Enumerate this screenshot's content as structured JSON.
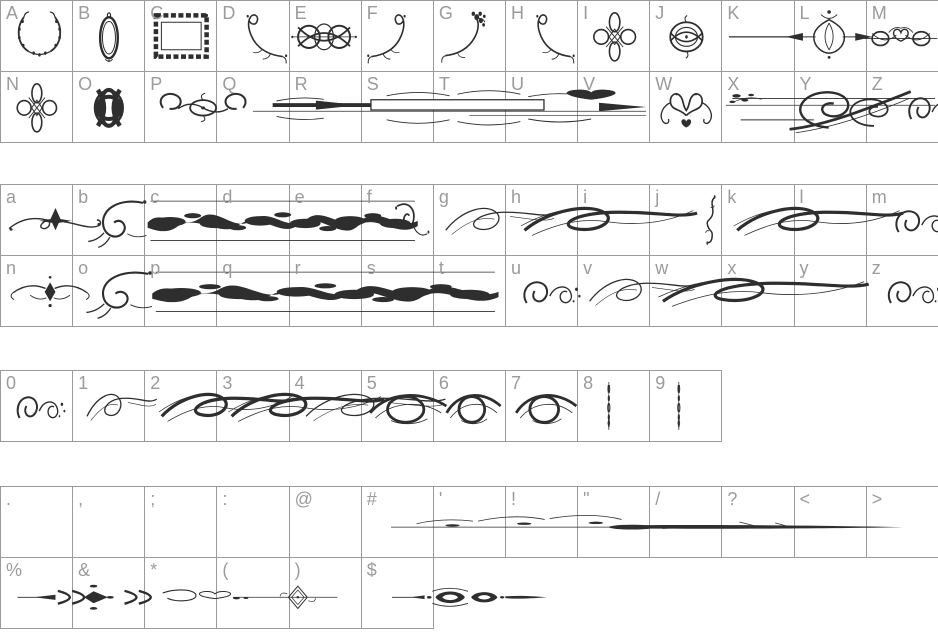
{
  "theme": {
    "background": "#ffffff",
    "grid_color": "#9b9b9b",
    "label_color": "#9b9b9b",
    "glyph_color": "#2e2e2e",
    "banner_fill": "#868686"
  },
  "sections": [
    {
      "name": "uppercase",
      "rows": [
        [
          {
            "label": "A",
            "glyph": "wreath",
            "span": 0.9,
            "dx": 0.08
          },
          {
            "label": "B",
            "glyph": "oval-frame",
            "span": 0.72,
            "dx": 0.14
          },
          {
            "label": "C",
            "glyph": "rect-frame",
            "span": 0.95,
            "dx": 0.03
          },
          {
            "label": "D",
            "glyph": "corner-flourish",
            "span": 0.95,
            "dx": 0.05,
            "flip": true
          },
          {
            "label": "E",
            "glyph": "knot-h",
            "span": 1.0,
            "dx": -0.02
          },
          {
            "label": "F",
            "glyph": "corner-flourish",
            "span": 0.9,
            "dx": 0.05
          },
          {
            "label": "G",
            "glyph": "corner-floral",
            "span": 0.95,
            "dx": 0.05
          },
          {
            "label": "H",
            "glyph": "corner-flourish",
            "span": 0.9,
            "dx": 0.08,
            "flip": true
          },
          {
            "label": "I",
            "glyph": "cross-knot",
            "span": 0.85,
            "dx": 0.08
          },
          {
            "label": "J",
            "glyph": "round-knot",
            "span": 0.9,
            "dx": 0.05
          },
          {
            "label": "K",
            "glyph": "line-divider",
            "span": 1.0,
            "dx": 0.05
          },
          {
            "label": "L",
            "glyph": "spear-knot",
            "span": 1.25,
            "dx": -0.15
          },
          {
            "label": "M",
            "glyph": "heart-scroll",
            "span": 1.05,
            "dx": -0.05
          }
        ],
        [
          {
            "label": "N",
            "glyph": "cross-knot",
            "span": 0.8,
            "dx": 0.1
          },
          {
            "label": "O",
            "glyph": "dense-knot",
            "span": 0.8,
            "dx": 0.1
          },
          {
            "label": "P",
            "glyph": "scroll-divider",
            "span": 1.5,
            "dx": 0.05
          },
          {
            "label": "Q",
            "glyph": "banner-rule",
            "span": 5.45,
            "dx": 0.5
          },
          {
            "label": "R"
          },
          {
            "label": "S"
          },
          {
            "label": "T"
          },
          {
            "label": "U"
          },
          {
            "label": "V"
          },
          {
            "label": "W",
            "glyph": "symmetric-flourish",
            "span": 0.95,
            "dx": 0.03
          },
          {
            "label": "X",
            "glyph": "triple-line",
            "span": 2.9,
            "dx": 0.05
          },
          {
            "label": "Y",
            "glyph": "grand-curl",
            "span": 1.75,
            "dx": -0.1
          },
          {
            "label": "Z",
            "glyph": "curl-cluster",
            "span": 0.9,
            "dx": 0.45
          }
        ]
      ]
    },
    {
      "name": "lowercase",
      "rows": [
        [
          {
            "label": "a",
            "glyph": "fleur-flourish",
            "span": 1.4,
            "dx": 0.05
          },
          {
            "label": "b",
            "glyph": "swirl-leaf",
            "span": 1.15,
            "dx": 0.1
          },
          {
            "label": "c",
            "glyph": "dense-band",
            "span": 3.9,
            "dx": -0.05
          },
          {
            "label": "d"
          },
          {
            "label": "e"
          },
          {
            "label": "f",
            "glyph": "swirl-tail",
            "span": 0.7,
            "dx": 0.3
          },
          {
            "label": "g",
            "glyph": "swash-light",
            "span": 1.65,
            "dx": 0.1
          },
          {
            "label": "h",
            "glyph": "swash-bold",
            "span": 2.6,
            "dx": 0.15
          },
          {
            "label": "i"
          },
          {
            "label": "j",
            "glyph": "small-curl",
            "span": 0.6,
            "dx": 0.55
          },
          {
            "label": "k",
            "glyph": "swash-bold",
            "span": 2.5,
            "dx": 0.1
          },
          {
            "label": "l"
          },
          {
            "label": "m",
            "glyph": "curl-cluster",
            "span": 1.0,
            "dx": 0.25
          }
        ],
        [
          {
            "label": "n",
            "glyph": "small-crest",
            "span": 1.25,
            "dx": 0.05
          },
          {
            "label": "o",
            "glyph": "swirl-leaf",
            "span": 1.3,
            "dx": 0.05
          },
          {
            "label": "p",
            "glyph": "dense-band",
            "span": 5.0,
            "dx": 0.0
          },
          {
            "label": "q"
          },
          {
            "label": "r"
          },
          {
            "label": "s"
          },
          {
            "label": "t"
          },
          {
            "label": "u",
            "glyph": "curl-cluster",
            "span": 1.0,
            "dx": 0.1
          },
          {
            "label": "v",
            "glyph": "swash-light",
            "span": 1.6,
            "dx": 0.1
          },
          {
            "label": "w",
            "glyph": "swash-bold",
            "span": 3.1,
            "dx": 0.05
          },
          {
            "label": "x"
          },
          {
            "label": "y"
          },
          {
            "label": "z",
            "glyph": "curl-cluster",
            "span": 0.95,
            "dx": 0.15
          }
        ]
      ]
    },
    {
      "name": "digits",
      "rows": [
        [
          {
            "label": "0",
            "glyph": "curl-cluster",
            "span": 0.85,
            "dx": 0.1
          },
          {
            "label": "1",
            "glyph": "swash-light",
            "span": 1.05,
            "dx": 0.15
          },
          {
            "label": "2",
            "glyph": "swash-bold",
            "span": 2.0,
            "dx": 0.15
          },
          {
            "label": "3",
            "glyph": "swash-bold",
            "span": 2.3,
            "dx": 0.1
          },
          {
            "label": "4",
            "glyph": "swash-light",
            "span": 2.1,
            "dx": 0.15
          },
          {
            "label": "5",
            "glyph": "round-swash",
            "span": 1.2,
            "dx": 0.05
          },
          {
            "label": "6",
            "glyph": "round-swash",
            "span": 0.85,
            "dx": 0.12
          },
          {
            "label": "7",
            "glyph": "round-swash",
            "span": 0.95,
            "dx": 0.08
          },
          {
            "label": "8",
            "glyph": "mini-stack",
            "span": 0.3,
            "dx": 0.28
          },
          {
            "label": "9",
            "glyph": "mini-stack",
            "span": 0.3,
            "dx": 0.25
          }
        ]
      ]
    },
    {
      "name": "punctuation",
      "rows": [
        [
          {
            "label": "."
          },
          {
            "label": ","
          },
          {
            "label": ";"
          },
          {
            "label": ":"
          },
          {
            "label": "@"
          },
          {
            "label": "#",
            "glyph": "taper-divider",
            "span": 7.1,
            "dx": 0.4
          },
          {
            "label": "'"
          },
          {
            "label": "!"
          },
          {
            "label": "\""
          },
          {
            "label": "/"
          },
          {
            "label": "?"
          },
          {
            "label": "<"
          },
          {
            "label": ">"
          }
        ],
        [
          {
            "label": "%",
            "glyph": "arrow-band",
            "span": 3.3,
            "dx": 0.2
          },
          {
            "label": "&"
          },
          {
            "label": "*"
          },
          {
            "label": "(",
            "glyph": "diamond-line",
            "span": 1.45,
            "dx": 0.22
          },
          {
            "label": ")"
          },
          {
            "label": "$",
            "glyph": "spear-divider",
            "span": 2.15,
            "dx": 0.42
          }
        ]
      ]
    }
  ]
}
